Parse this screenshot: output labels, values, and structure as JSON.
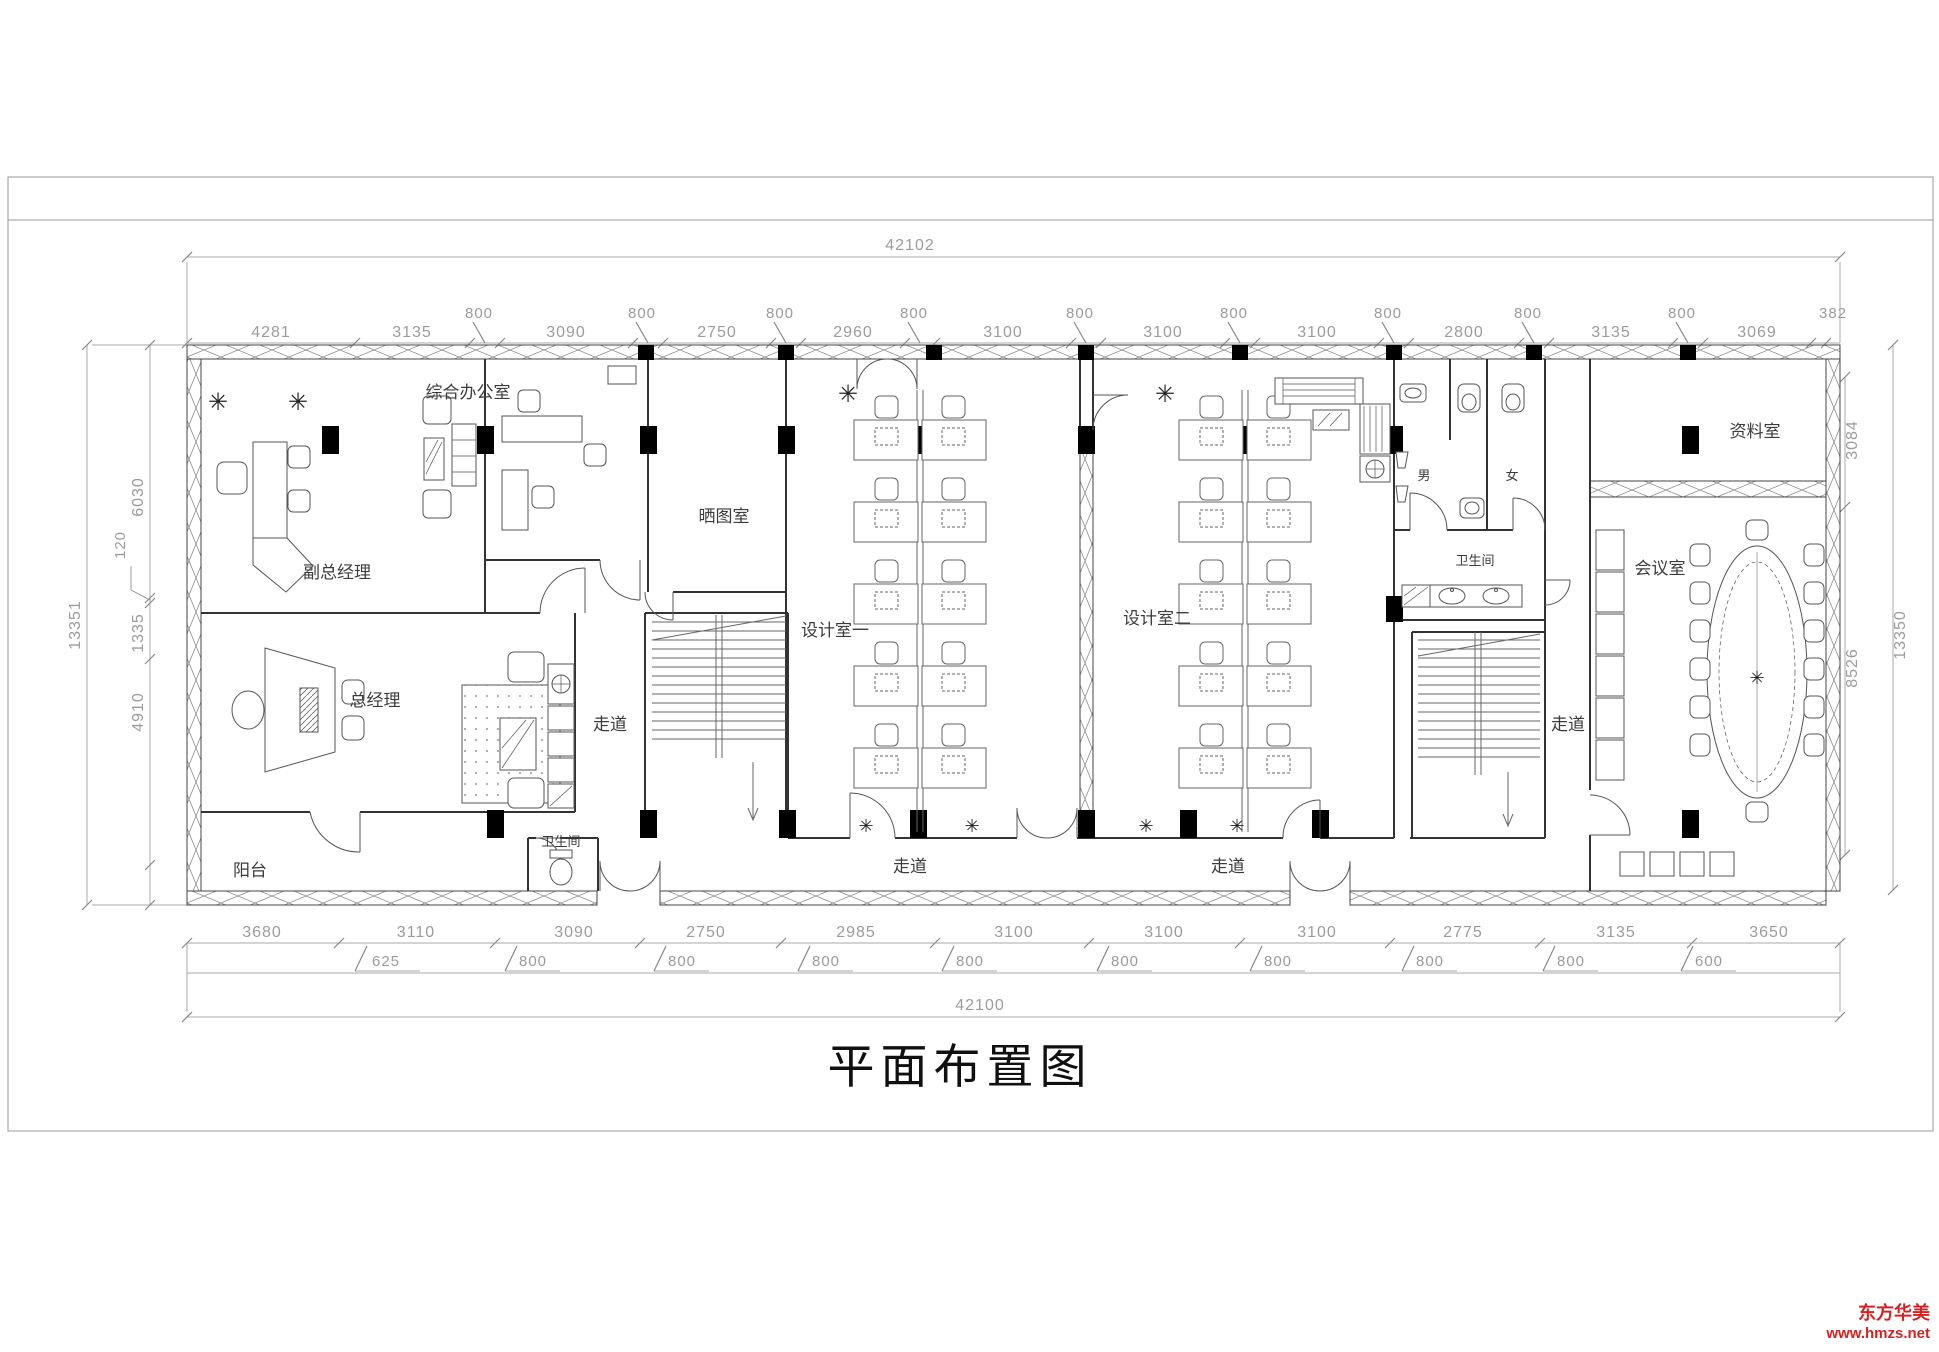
{
  "title": "平面布置图",
  "watermark": {
    "line1": "东方华美",
    "line2": "www.hmzs.net",
    "color": "#d42222"
  },
  "icons": {
    "plant": "✳"
  },
  "rooms": {
    "deputy_gm": "副总经理",
    "gm": "总经理",
    "general_office": "综合办公室",
    "blueprint": "晒图室",
    "design1": "设计室一",
    "design2": "设计室二",
    "archive": "资料室",
    "meeting": "会议室",
    "wc_main": "卫生间",
    "wc_small": "卫生间",
    "male": "男",
    "female": "女",
    "balcony": "阳台",
    "corridor1": "走道",
    "corridor2": "走道",
    "corridor3": "走道",
    "corridor4": "走道"
  },
  "dims": {
    "top_total": "42102",
    "bottom_total": "42100",
    "top": [
      "4281",
      "3135",
      "800",
      "3090",
      "800",
      "2750",
      "800",
      "2960",
      "800",
      "3100",
      "800",
      "3100",
      "800",
      "3100",
      "800",
      "2800",
      "800",
      "3135",
      "800",
      "3069",
      "382"
    ],
    "bottom1": [
      "3680",
      "3110",
      "3090",
      "2750",
      "2985",
      "3100",
      "3100",
      "3100",
      "2775",
      "3135",
      "3650"
    ],
    "bottom2": [
      "625",
      "800",
      "800",
      "800",
      "800",
      "800",
      "800",
      "800",
      "800",
      "600"
    ],
    "left": [
      "13351",
      "6030",
      "120",
      "1335",
      "4910"
    ],
    "right": [
      "3084",
      "8526",
      "13350"
    ]
  }
}
